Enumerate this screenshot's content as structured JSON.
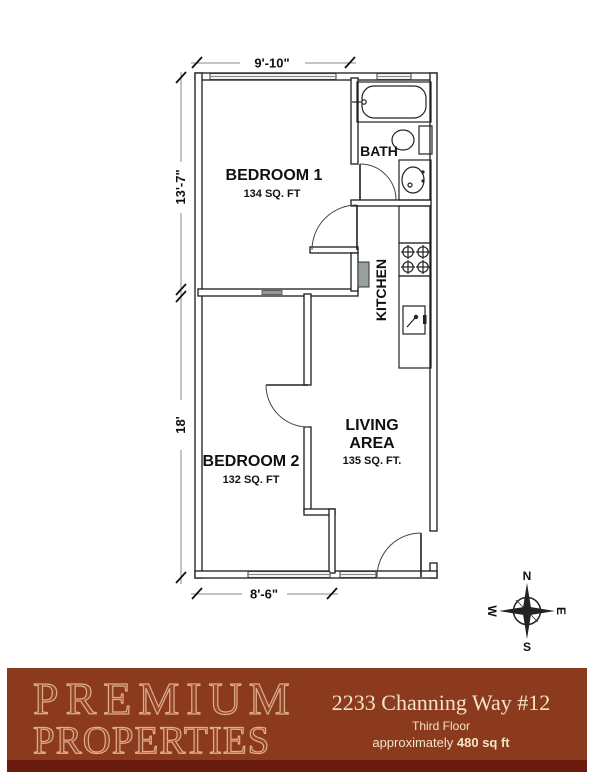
{
  "floor_plan": {
    "rooms": {
      "bedroom1": {
        "name": "BEDROOM 1",
        "area": "134 SQ. FT"
      },
      "bedroom2": {
        "name": "BEDROOM 2",
        "area": "132 SQ. FT"
      },
      "living": {
        "name_line1": "LIVING",
        "name_line2": "AREA",
        "area": "135 SQ. FT."
      },
      "bath": {
        "name": "BATH"
      },
      "kitchen": {
        "name": "KITCHEN"
      }
    },
    "dimensions": {
      "top": "9'-10\"",
      "left_upper": "13'-7\"",
      "left_lower": "18'",
      "bottom": "8'-6\""
    },
    "fixtures": [
      "bathtub",
      "toilet",
      "bath-sink",
      "stove",
      "kitchen-sink",
      "counter",
      "water-heater"
    ],
    "compass": {
      "north": "N",
      "south": "S",
      "west": "W",
      "east": "E"
    },
    "line_color": "#1b1b1b"
  },
  "footer": {
    "brand_line1": "PREMIUM",
    "brand_line2": "PROPERTIES",
    "address": "2233 Channing Way #12",
    "floor_label": "Third Floor",
    "approx_label": "approximately ",
    "area_bold": "480 sq ft",
    "colors": {
      "background": "#8B3A1D",
      "bottom_band": "#6B1A0E",
      "logo_outline": "#DFAE8D",
      "text": "#F1E4C6"
    }
  }
}
